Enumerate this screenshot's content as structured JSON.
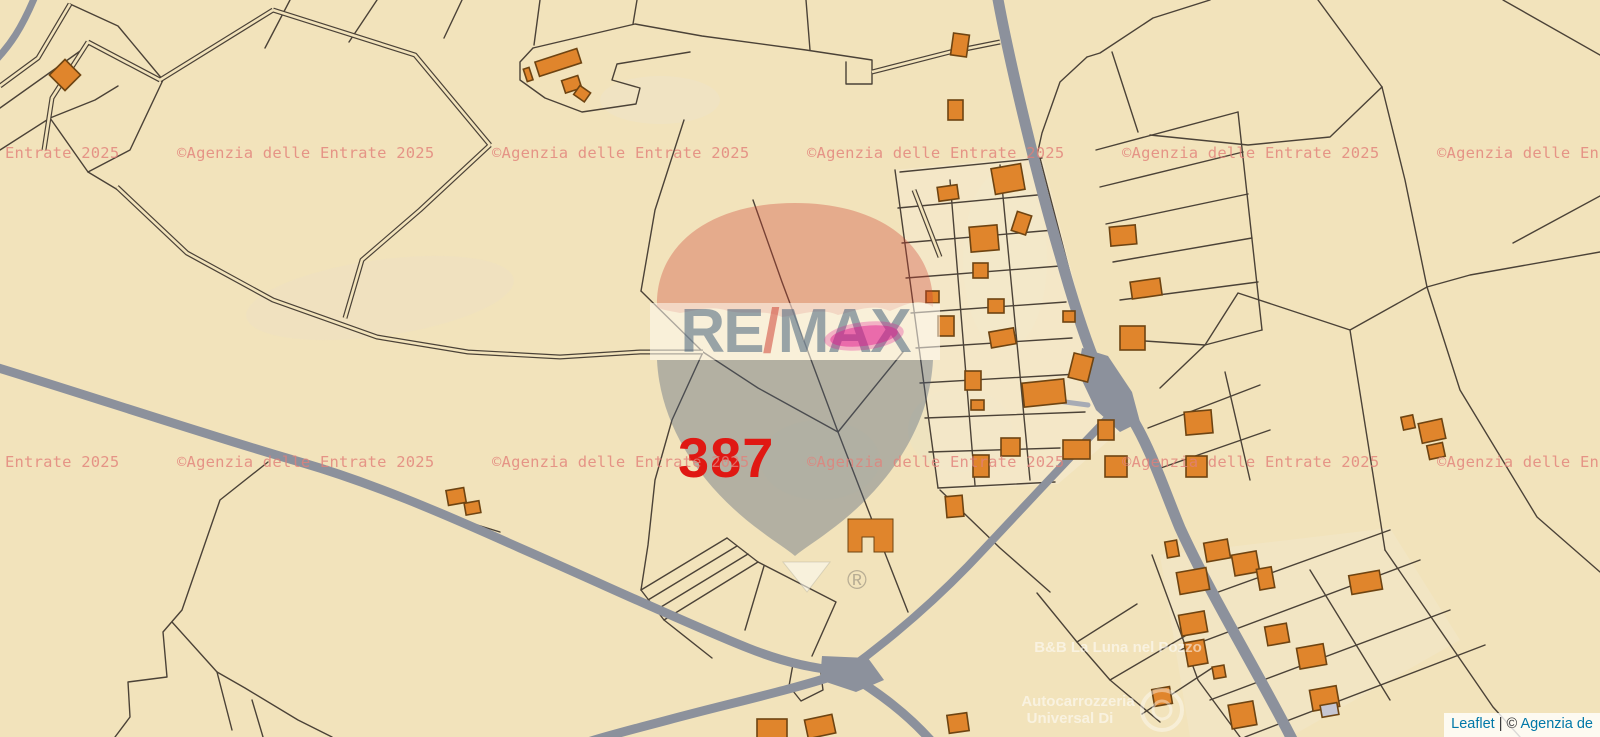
{
  "map": {
    "parcel_number": "387",
    "watermark": {
      "text": "©Agenzia delle Entrate 2025",
      "color": "#e2807a"
    },
    "balloon": {
      "re": "RE",
      "slash": "/",
      "max": "MAX",
      "registered": "®"
    },
    "poi_labels": {
      "bnb": "B&B La Luna nel Pozzo",
      "autocarrozzeria_line1": "Autocarrozzeria",
      "autocarrozzeria_line2": "Universal Di"
    },
    "colors": {
      "background": "#f2e3bb",
      "background_light": "#f7eeda",
      "building": "#e0852c",
      "building_outline": "#6e4412",
      "building_gray": "#c6c6d2",
      "road": "#8c919c",
      "road_minor": "#a7abb5",
      "parcel_line": "#4b4237",
      "parcel_number_color": "#e01813",
      "highlight": "#e0138b"
    }
  },
  "attribution": {
    "leaflet": "Leaflet",
    "separator": " | © ",
    "provider": "Agenzia de"
  }
}
